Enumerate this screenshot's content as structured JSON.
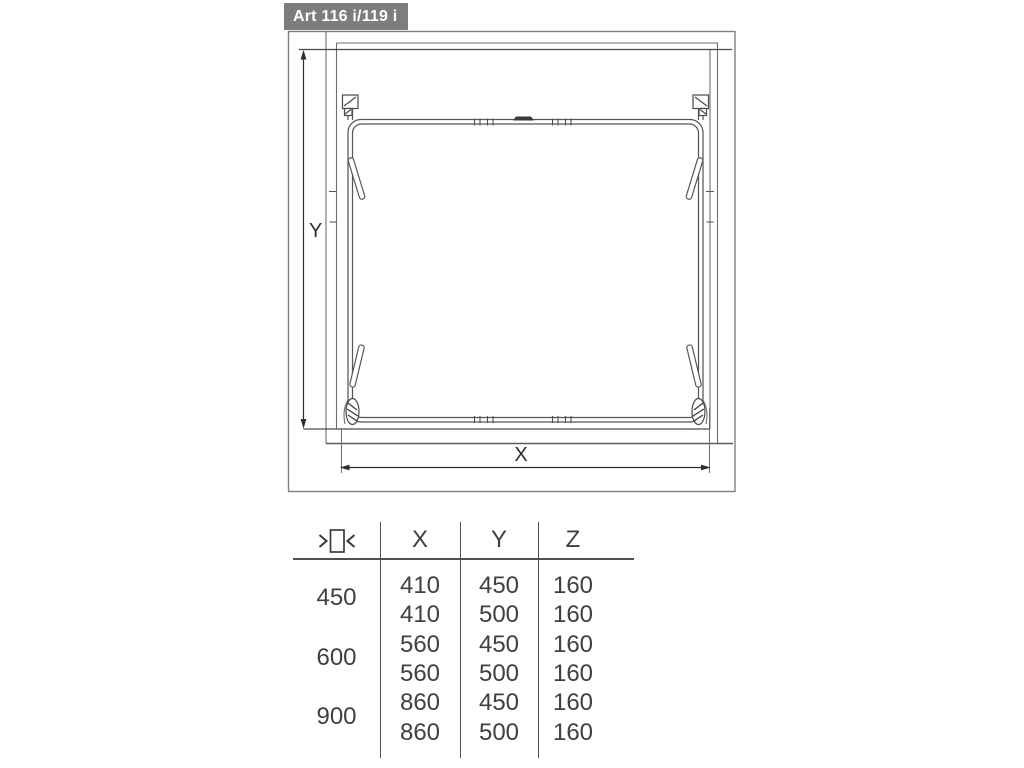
{
  "title": "Art 116 i/119 i",
  "drawing": {
    "dim_labels": {
      "x": "X",
      "y": "Y"
    }
  },
  "table": {
    "header": {
      "symbol_icon": "cabinet-width-arrows-icon",
      "columns": [
        "X",
        "Y",
        "Z"
      ]
    },
    "groups": [
      {
        "label": "450",
        "rows": [
          {
            "x": "410",
            "y": "450",
            "z": "160"
          },
          {
            "x": "410",
            "y": "500",
            "z": "160"
          }
        ]
      },
      {
        "label": "600",
        "rows": [
          {
            "x": "560",
            "y": "450",
            "z": "160"
          },
          {
            "x": "560",
            "y": "500",
            "z": "160"
          }
        ]
      },
      {
        "label": "900",
        "rows": [
          {
            "x": "860",
            "y": "450",
            "z": "160"
          },
          {
            "x": "860",
            "y": "500",
            "z": "160"
          }
        ]
      }
    ]
  }
}
